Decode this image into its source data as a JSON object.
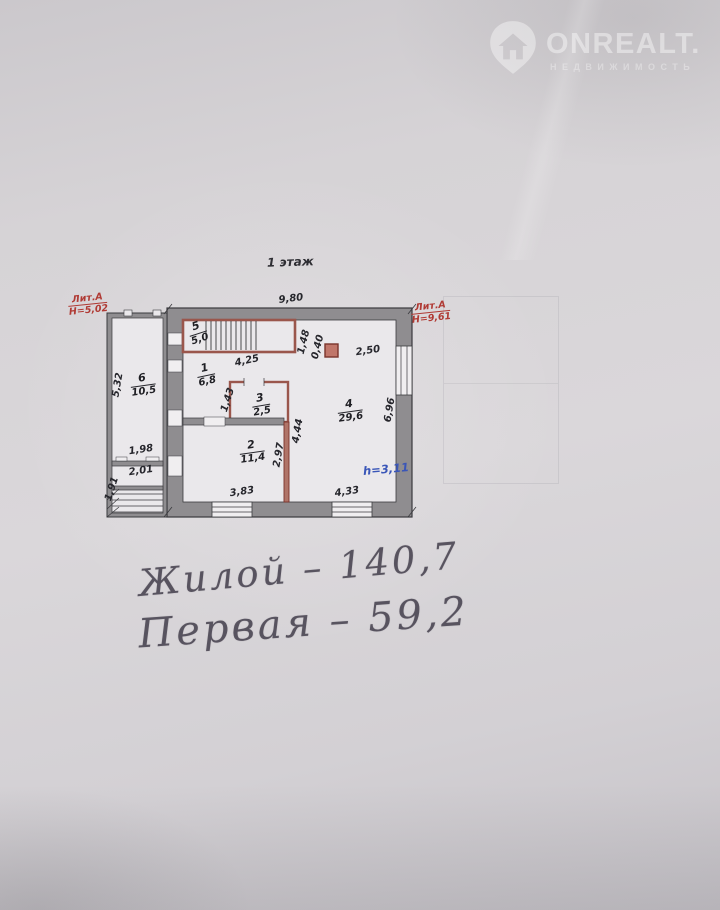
{
  "watermark": {
    "icon": "house-pin-icon",
    "brand": "ONREALT.",
    "subtitle": "НЕДВИЖИМОСТЬ"
  },
  "plan": {
    "title": "1 этаж",
    "lit_left": {
      "name": "Лит.А",
      "height": "Н=5,02"
    },
    "lit_right": {
      "name": "Лит.А",
      "height": "Н=9,61"
    },
    "rooms": [
      {
        "num": "5",
        "area": "5,0"
      },
      {
        "num": "1",
        "area": "6,8"
      },
      {
        "num": "3",
        "area": "2,5"
      },
      {
        "num": "2",
        "area": "11,4"
      },
      {
        "num": "4",
        "area": "29,6"
      },
      {
        "num": "6",
        "area": "10,5"
      }
    ],
    "dims": {
      "width_top": "9,80",
      "stair_bottom": "4,25",
      "stair_right": "1,48",
      "chimney_offset": "0,40",
      "chimney_right": "2,50",
      "room3_left": "1,43",
      "room2_right": "2,97",
      "room4_left": "4,44",
      "room4_right": "6,96",
      "room2_bottom": "3,83",
      "room4_bottom": "4,33",
      "annex_left": "5,32",
      "annex_width": "1,98",
      "annex_room": "2,01",
      "annex_bottom_left": "1,91"
    },
    "ceiling_height": "h=3,11"
  },
  "notes": {
    "line1": "Жилой – 140,7",
    "line2": "Первая – 59,2"
  },
  "colors": {
    "wall_gray": "#8f8d90",
    "partition_red": "#9a564c",
    "dim_red": "#b03a34",
    "note_blue": "#3a56b8"
  }
}
